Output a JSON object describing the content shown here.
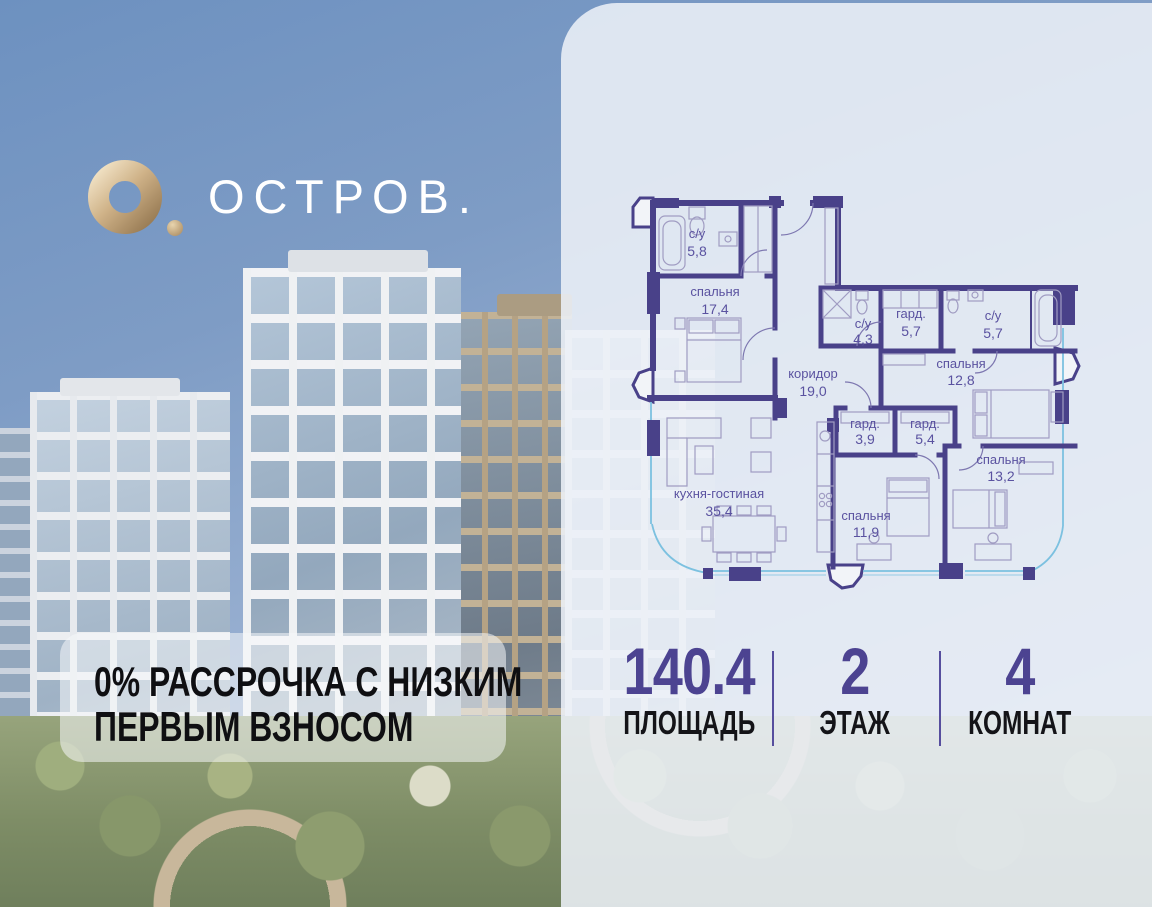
{
  "brand": {
    "name": "ОСТРОВ."
  },
  "promo": {
    "line1": "0% РАССРОЧКА С НИЗКИМ",
    "line2": "ПЕРВЫМ ВЗНОСОМ"
  },
  "stats": [
    {
      "value": "140.4",
      "label": "ПЛОЩАДЬ"
    },
    {
      "value": "2",
      "label": "ЭТАЖ"
    },
    {
      "value": "4",
      "label": "КОМНАТ"
    }
  ],
  "floorplan": {
    "rooms": [
      {
        "name": "с/у",
        "area": "5,8"
      },
      {
        "name": "спальня",
        "area": "17,4"
      },
      {
        "name": "коридор",
        "area": "19,0"
      },
      {
        "name": "с/у",
        "area": "4,3"
      },
      {
        "name": "гард.",
        "area": "5,7"
      },
      {
        "name": "с/у",
        "area": "5,7"
      },
      {
        "name": "спальня",
        "area": "12,8"
      },
      {
        "name": "гард.",
        "area": "3,9"
      },
      {
        "name": "гард.",
        "area": "5,4"
      },
      {
        "name": "кухня-гостиная",
        "area": "35,4"
      },
      {
        "name": "спальня",
        "area": "11,9"
      },
      {
        "name": "спальня",
        "area": "13,2"
      }
    ]
  },
  "colors": {
    "accent_purple": "#4c4391",
    "plan_wall": "#494189",
    "logo_gold": "#c9a877",
    "glazing_blue": "#7cc1e0",
    "sky": "#7e9cc5"
  }
}
